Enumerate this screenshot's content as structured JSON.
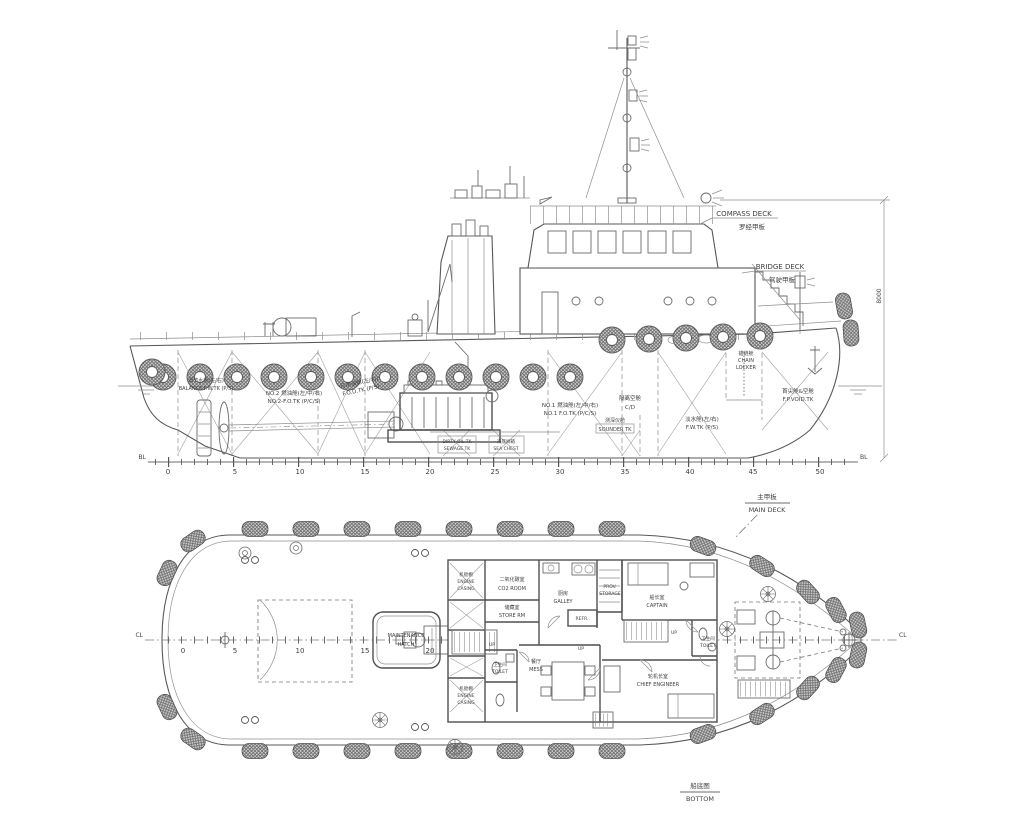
{
  "side": {
    "compass_deck": {
      "en": "COMPASS DECK",
      "zh": "罗经甲板"
    },
    "bridge_deck": {
      "en": "BRIDGE DECK",
      "zh": "驾驶甲板"
    },
    "chain_locker": {
      "zh": "锚链舱",
      "en1": "CHAIN",
      "en2": "LOCKER"
    },
    "fp_void": {
      "zh": "首尖舱&空舱",
      "en": "F.P.VOID.TK"
    },
    "balance": {
      "zh": "调节水舱(左/右)",
      "en": "BALANCE F.W.TK (P/S)"
    },
    "no2_fo": {
      "zh": "NO.2 燃油舱(左/中/右)",
      "en": "NO.2-F.O.TK (P/C/S)"
    },
    "fod": {
      "zh": "日用油舱(左/右)",
      "en": "F.O.D.TK (P/S)"
    },
    "no1_fo": {
      "zh": "NO.1 燃油舱(左/中/右)",
      "en": "NO.1 F.O.TK (P/C/S)"
    },
    "cofferdam": {
      "zh": "隔离空舱",
      "en": "C/D"
    },
    "sounder": {
      "zh": "测深仪舱",
      "en": "SOUNDER TK"
    },
    "fw": {
      "zh": "淡水舱(左/右)",
      "en": "F.W.TK (P/S)"
    },
    "dirty_oil": {
      "l1": "DIRTY OIL TK",
      "l2": "SEWAGE TK"
    },
    "sea_chest": {
      "zh": "海底阀箱",
      "en": "SEA CHEST"
    },
    "dimension": "8000",
    "bl": "BL",
    "frames": [
      "0",
      "5",
      "10",
      "15",
      "20",
      "25",
      "30",
      "35",
      "40",
      "45",
      "50"
    ]
  },
  "plan": {
    "main_deck": {
      "zh": "主甲板",
      "en": "MAIN DECK"
    },
    "engine_casing": {
      "zh": "机舱棚",
      "en1": "ENGINE",
      "en2": "CASING"
    },
    "co2_room": {
      "zh": "二氧化碳室",
      "en": "CO2 ROOM"
    },
    "store_rm": {
      "zh": "储藏室",
      "en": "STORE RM"
    },
    "galley": {
      "zh": "厨房",
      "en": "GALLEY"
    },
    "refr": "REFR.",
    "prov": {
      "en1": "PROV.",
      "en2": "STORAGE"
    },
    "captain": {
      "zh": "船长室",
      "en": "CAPTAIN"
    },
    "toilet": {
      "zh": "卫生间",
      "en": "TOILET"
    },
    "chief_engineer": {
      "zh": "轮机长室",
      "en": "CHIEF ENGINEER"
    },
    "mess": {
      "zh": "餐厅",
      "en": "MESS"
    },
    "maintenance": {
      "l1": "MAINTENANCE",
      "l2": "HATCH"
    },
    "up": "UP",
    "cl": "CL",
    "frames": [
      "0",
      "5",
      "10",
      "15",
      "20",
      "25",
      "30",
      "35"
    ]
  },
  "bottom": {
    "zh": "船底图",
    "en": "BOTTOM"
  }
}
